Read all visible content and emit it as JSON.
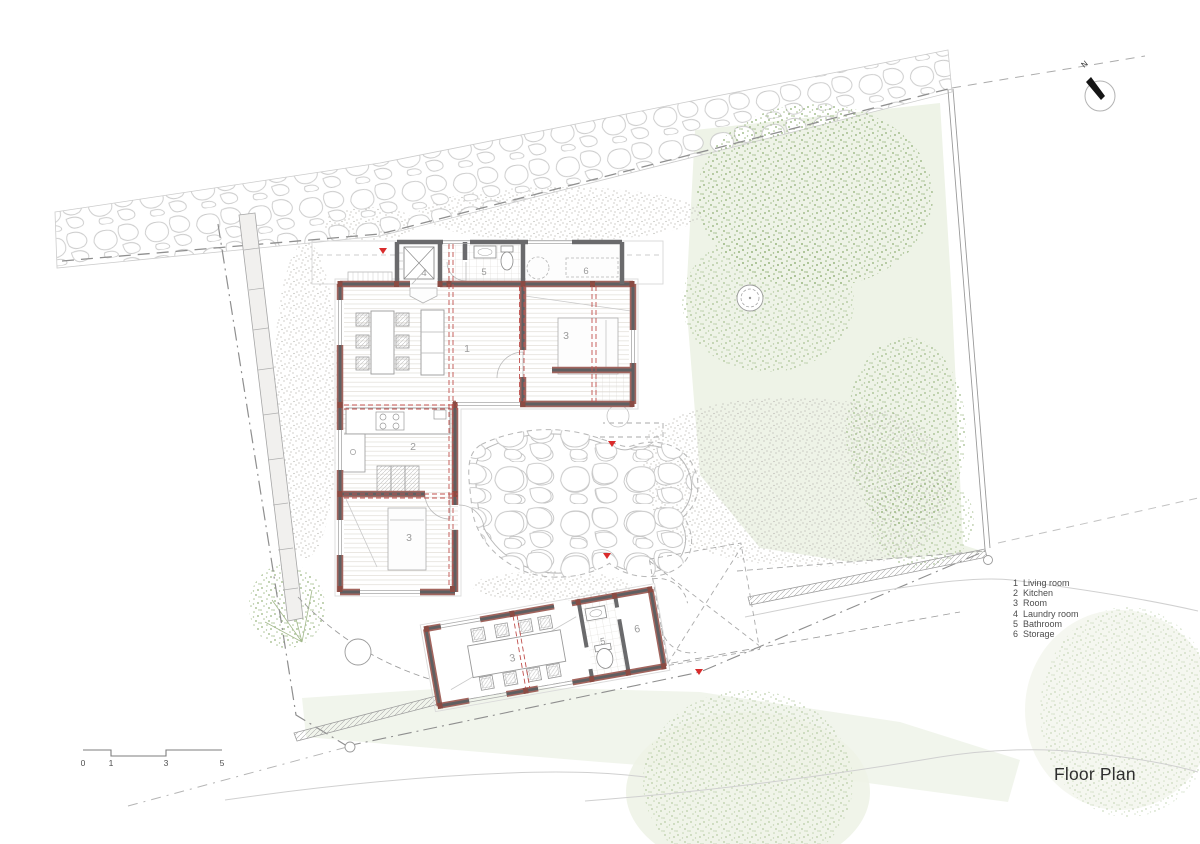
{
  "page": {
    "title": "Floor Plan"
  },
  "north": {
    "label": "N"
  },
  "scale_bar": {
    "tick_labels": [
      "0",
      "1",
      "3",
      "5"
    ]
  },
  "legend": {
    "items": [
      {
        "num": "1",
        "label": "Living room"
      },
      {
        "num": "2",
        "label": "Kitchen"
      },
      {
        "num": "3",
        "label": "Room"
      },
      {
        "num": "4",
        "label": "Laundry room"
      },
      {
        "num": "5",
        "label": "Bathroom"
      },
      {
        "num": "6",
        "label": "Storage"
      }
    ]
  },
  "room_labels": {
    "living": "1",
    "kitchen": "2",
    "room_east": "3",
    "room_south": "3",
    "laundry": "4",
    "bathroom": "5",
    "storage": "6",
    "annex_room": "3",
    "annex_bathroom": "5",
    "annex_storage": "6"
  },
  "colors": {
    "wall_gray": "#5f5f61",
    "wall_accent": "#a2655e",
    "column_red": "#8a4b43",
    "red_grid": "#c0504d",
    "red_marker": "#d92b2b",
    "foliage_green": "#9cb884",
    "wash_green": "#edf2e6",
    "boundary_gray": "#8f8f8f",
    "stone_gray": "#c9c9c9",
    "label_gray": "#9b9b9b"
  }
}
